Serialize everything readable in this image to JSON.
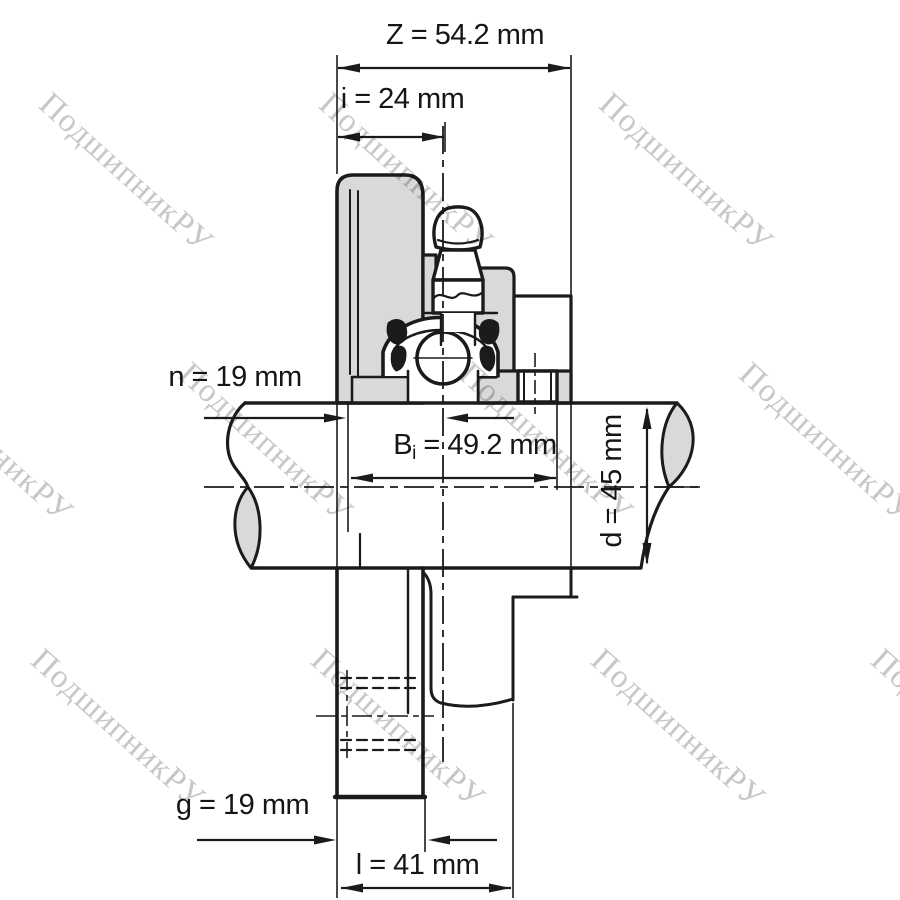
{
  "diagram": {
    "type": "bearing-unit-technical-drawing",
    "watermark": {
      "text": "ПодшипникРУ",
      "color": "#c7c7c7"
    },
    "colors": {
      "line": "#1b1b1b",
      "section_fill": "#d9d9d9",
      "background": "#ffffff"
    },
    "dimensions": {
      "Z": {
        "label": "Z = 54.2 mm",
        "symbol": "Z",
        "value": 54.2,
        "unit": "mm"
      },
      "i": {
        "label": "i = 24 mm",
        "symbol": "i",
        "value": 24,
        "unit": "mm"
      },
      "n": {
        "label": "n = 19 mm",
        "symbol": "n",
        "value": 19,
        "unit": "mm"
      },
      "Bi": {
        "base": "B",
        "sub": "i",
        "rest": " = 49.2 mm",
        "value": 49.2,
        "unit": "mm"
      },
      "d": {
        "label": "d = 45 mm",
        "symbol": "d",
        "value": 45,
        "unit": "mm"
      },
      "g": {
        "label": "g = 19 mm",
        "symbol": "g",
        "value": 19,
        "unit": "mm"
      },
      "l": {
        "label": "l = 41 mm",
        "symbol": "l",
        "value": 41,
        "unit": "mm"
      }
    }
  }
}
